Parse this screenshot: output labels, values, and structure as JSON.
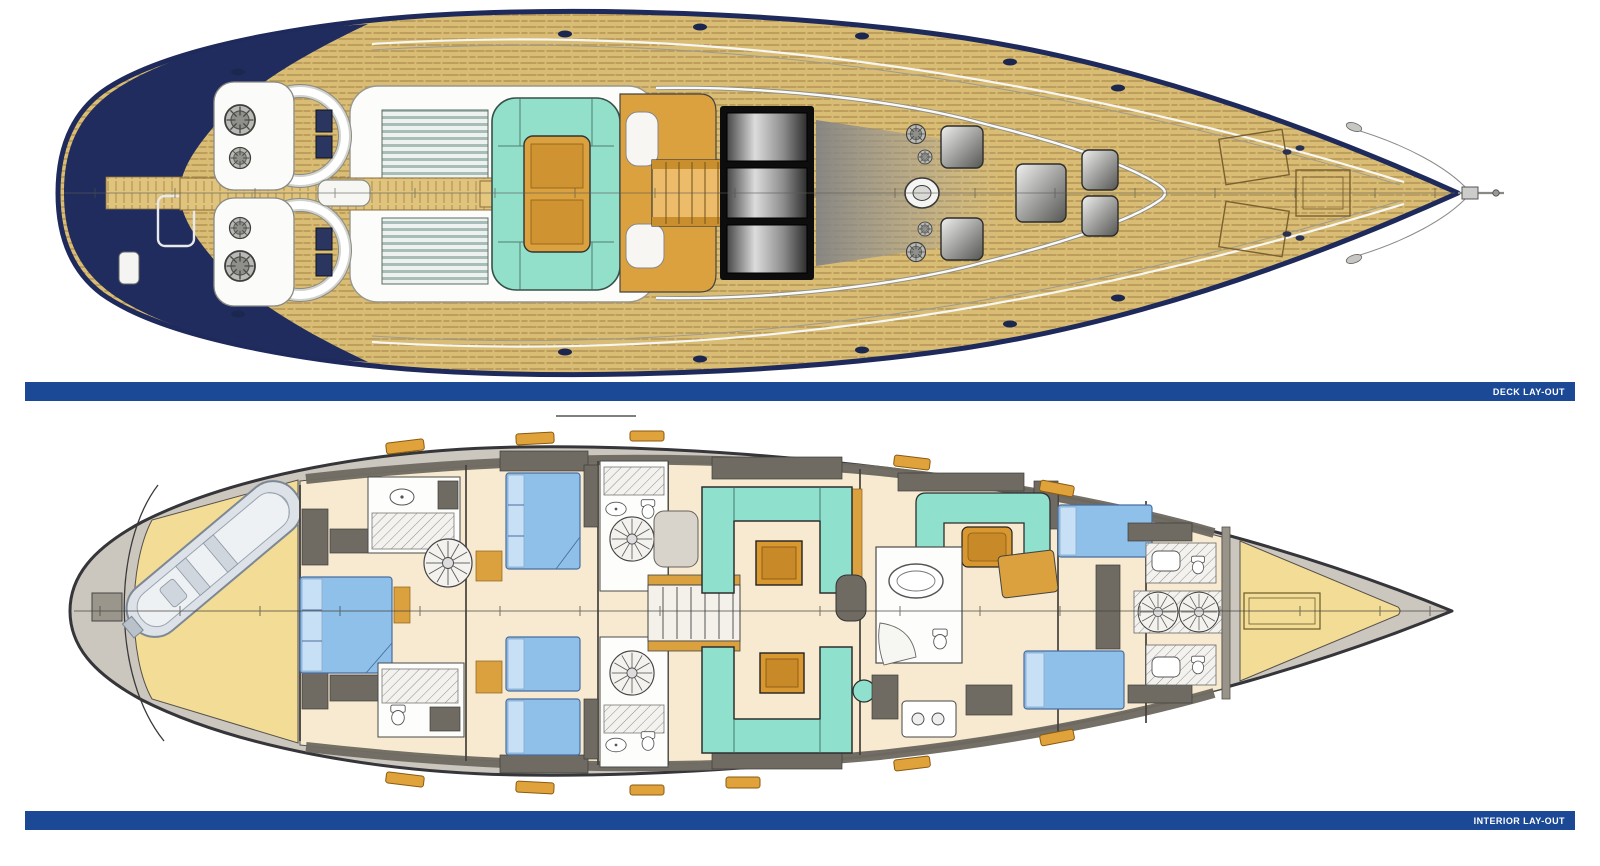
{
  "sections": {
    "deck": {
      "label": "DECK LAY-OUT"
    },
    "interior": {
      "label": "INTERIOR LAY-OUT"
    }
  },
  "colors": {
    "caption_bar": "#1b4996",
    "caption_text": "#ffffff",
    "hull_navy": "#202c5e",
    "teak_deck": "#d9bd74",
    "cockpit_cushion_aqua": "#92dfca",
    "wood_orange": "#dba13e",
    "window_dark": "#2f2f2f",
    "interior_floor_cream": "#f7ead0",
    "sail_locker_yellow": "#f2dc96",
    "bed_blue": "#8fc0ea",
    "sofa_teal": "#8fe0cd",
    "hull_margin_gray": "#cbc7bf",
    "wall_gray": "#6f6b62"
  }
}
